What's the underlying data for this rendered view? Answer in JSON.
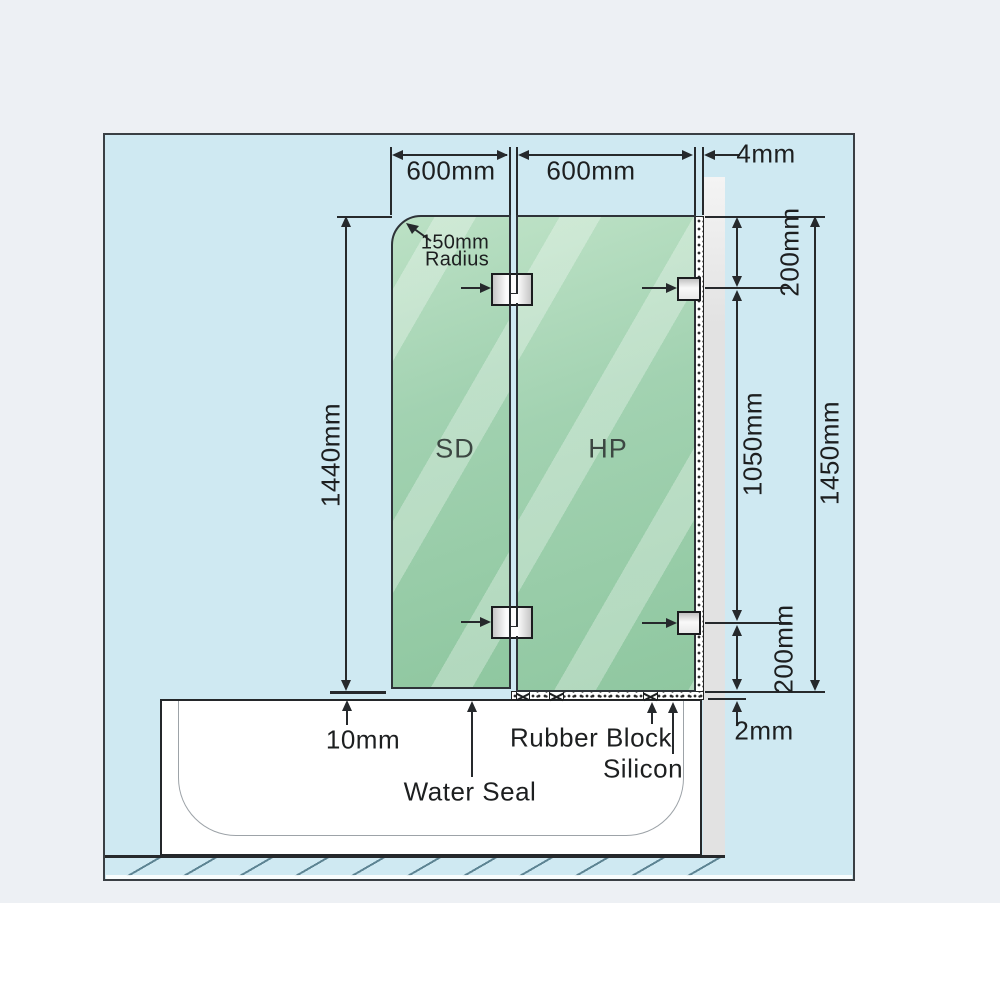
{
  "labels": {
    "panel_width_left": "600mm",
    "panel_width_right": "600mm",
    "wall_gap": "4mm",
    "radius_value": "150mm",
    "radius_word": "Radius",
    "door_height": "1440mm",
    "top_bracket_offset": "200mm",
    "bracket_span": "1050mm",
    "fixed_panel_height": "1450mm",
    "bottom_bracket_offset": "200mm",
    "door_bottom_gap": "10mm",
    "water_seal": "Water Seal",
    "rubber_block": "Rubber Block",
    "silicon": "Silicon",
    "panel_bottom_gap": "2mm",
    "shower_door": "SD",
    "hinge_panel": "HP"
  },
  "colors": {
    "page_background": "#edf0f4",
    "diagram_background": "#cfe9f2",
    "glass_green": "#9bcfab",
    "wall_grey": "#e2e2e2",
    "line": "#26292c"
  }
}
